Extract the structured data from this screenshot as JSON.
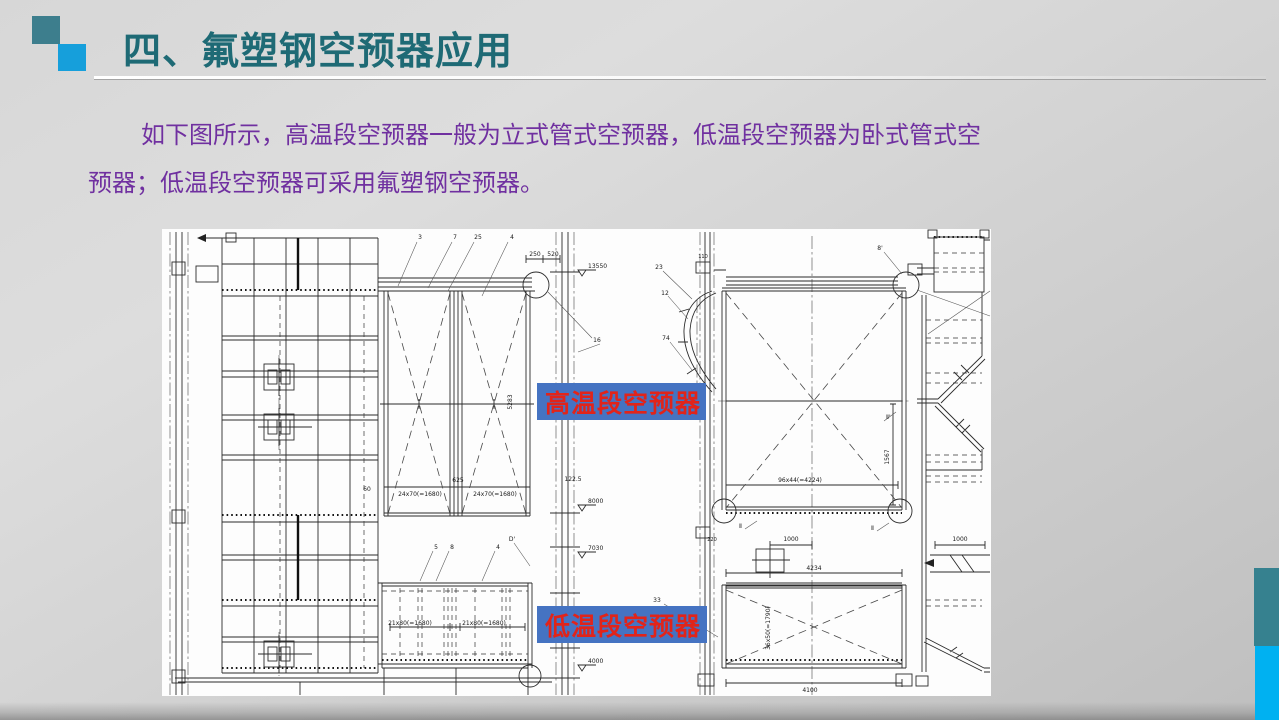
{
  "slide": {
    "title": "四、氟塑钢空预器应用",
    "body": {
      "line1": "如下图所示，高温段空预器一般为立式管式空预器，低温段空预器为卧式管式空",
      "line2": "预器；低温段空预器可采用氟塑钢空预器。"
    }
  },
  "colors": {
    "title_text": "#1e6a75",
    "body_text": "#7030a0",
    "label_background": "#4573c2",
    "label_text": "#e1241a",
    "accent_square_dark": "#3d7e8d",
    "accent_square_light": "#169fdb",
    "sidebar_teal": "#36818f",
    "sidebar_blue": "#00b1f1",
    "drawing_background": "#fdfdfd"
  },
  "diagram": {
    "labels": [
      {
        "text": "高温段空预器"
      },
      {
        "text": "低温段空预器"
      }
    ],
    "texts": [
      {
        "x": 420,
        "y": 239,
        "t": "3"
      },
      {
        "x": 455,
        "y": 239,
        "t": "7"
      },
      {
        "x": 478,
        "y": 239,
        "t": "25"
      },
      {
        "x": 512,
        "y": 239,
        "t": "4"
      },
      {
        "x": 535,
        "y": 256,
        "t": "250"
      },
      {
        "x": 553,
        "y": 256,
        "t": "520"
      },
      {
        "x": 588,
        "y": 268,
        "t": "13550",
        "a": "start"
      },
      {
        "x": 659,
        "y": 269,
        "t": "23"
      },
      {
        "x": 665,
        "y": 295,
        "t": "12"
      },
      {
        "x": 666,
        "y": 340,
        "t": "74"
      },
      {
        "x": 597,
        "y": 342,
        "t": "16"
      },
      {
        "x": 880,
        "y": 250,
        "t": "8'"
      },
      {
        "x": 703,
        "y": 258,
        "t": "110",
        "s": 5
      },
      {
        "x": 800,
        "y": 482,
        "t": "96x44(=4224)"
      },
      {
        "x": 889,
        "y": 457,
        "t": "1567",
        "r": -90
      },
      {
        "x": 512,
        "y": 402,
        "t": "5283",
        "r": -90
      },
      {
        "x": 367,
        "y": 491,
        "t": "60"
      },
      {
        "x": 420,
        "y": 496,
        "t": "24x70(=1680)"
      },
      {
        "x": 495,
        "y": 496,
        "t": "24x70(=1680)"
      },
      {
        "x": 458,
        "y": 482,
        "t": "625"
      },
      {
        "x": 573,
        "y": 481,
        "t": "122.5"
      },
      {
        "x": 588,
        "y": 503,
        "t": "8000",
        "a": "start"
      },
      {
        "x": 588,
        "y": 550,
        "t": "7030",
        "a": "start"
      },
      {
        "x": 436,
        "y": 549,
        "t": "5"
      },
      {
        "x": 452,
        "y": 549,
        "t": "8"
      },
      {
        "x": 498,
        "y": 549,
        "t": "4"
      },
      {
        "x": 512,
        "y": 541,
        "t": "D'"
      },
      {
        "x": 791,
        "y": 541,
        "t": "1000"
      },
      {
        "x": 960,
        "y": 541,
        "t": "1000"
      },
      {
        "x": 814,
        "y": 570,
        "t": "4234"
      },
      {
        "x": 657,
        "y": 602,
        "t": "33"
      },
      {
        "x": 410,
        "y": 625,
        "t": "21x80(=1680)"
      },
      {
        "x": 484,
        "y": 625,
        "t": "21x80(=1680)"
      },
      {
        "x": 770,
        "y": 628,
        "t": "36x50(=1790)",
        "r": -90
      },
      {
        "x": 588,
        "y": 663,
        "t": "4000",
        "a": "start"
      },
      {
        "x": 810,
        "y": 692,
        "t": "4100"
      },
      {
        "x": 712,
        "y": 541,
        "t": "220",
        "s": 5
      },
      {
        "x": 742,
        "y": 528,
        "t": "Ⅱ",
        "a": "end"
      },
      {
        "x": 874,
        "y": 530,
        "t": "Ⅱ",
        "a": "end"
      },
      {
        "x": 886,
        "y": 419,
        "t": "Ⅱ'",
        "a": "start"
      }
    ]
  }
}
